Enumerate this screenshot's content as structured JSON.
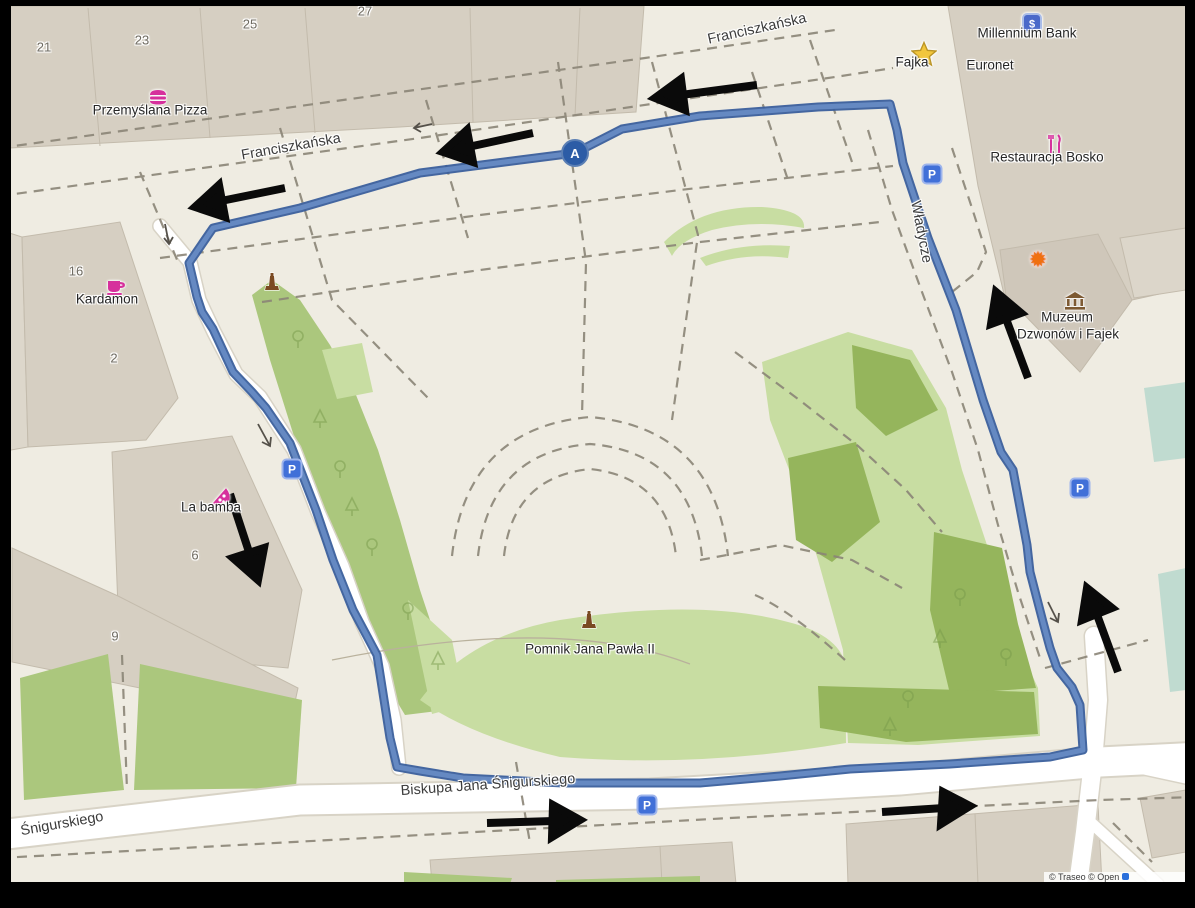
{
  "map": {
    "route": {
      "start_marker_label": "A"
    },
    "markers": {
      "parking_label": "P"
    },
    "streets": [
      {
        "label": "Franciszkańska"
      },
      {
        "label": "Franciszkańska"
      },
      {
        "label": "Władycze"
      },
      {
        "label": "Biskupa Jana Śnigurskiego"
      },
      {
        "label": "Śnigurskiego"
      }
    ],
    "pois": [
      {
        "name": "Przemyślana Pizza"
      },
      {
        "name": "Fajka"
      },
      {
        "name": "Millennium Bank"
      },
      {
        "name": "Euronet"
      },
      {
        "name": "Restauracja Bosko"
      },
      {
        "name": "Muzeum",
        "name_line2": "Dzwonów i Fajek"
      },
      {
        "name": "Kardamon"
      },
      {
        "name": "La bamba"
      },
      {
        "name": "Pomnik Jana Pawła II"
      }
    ],
    "house_numbers": [
      "21",
      "23",
      "25",
      "27",
      "16",
      "2",
      "6",
      "9"
    ],
    "attribution": "© Traseo © Open",
    "colors": {
      "route": "#3a5f9c",
      "route_inner": "#6589c2",
      "park_light": "#c8dda2",
      "park_mid": "#abc77d",
      "park_dark": "#95b55c",
      "water_teal": "#c0dbd0",
      "building": "#d6cfc2",
      "road": "#ffffff",
      "poi_magenta": "#d6309c",
      "parking_blue": "#4170d8",
      "arrow_black": "#0a0a0a"
    }
  }
}
